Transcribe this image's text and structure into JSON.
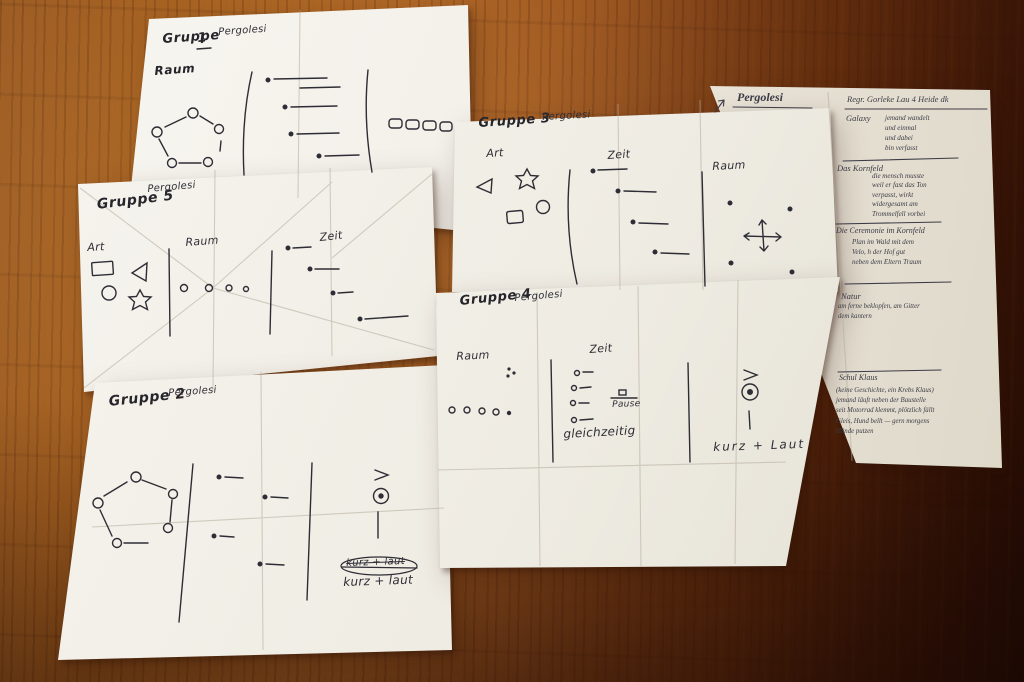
{
  "scene": {
    "description": "Five handwritten graphic-notation sketch sheets and one notes sheet on a wooden table",
    "colors": {
      "wood": "#9b5520",
      "wood_dark": "#431808",
      "paper": "#f2efe8",
      "ink": "#2e2d35"
    }
  },
  "papers": {
    "gruppe1": {
      "header": "Gruppe",
      "number": "1",
      "composer": "Pergolesi",
      "label_raum": "Raum"
    },
    "gruppe5": {
      "header": "Gruppe 5",
      "composer": "Pergolesi",
      "label_art": "Art",
      "label_raum": "Raum",
      "label_zeit": "Zeit"
    },
    "gruppe2": {
      "header": "Gruppe 2",
      "composer": "Pergolesi",
      "caption_struck": "kurz + laut",
      "caption": "kurz + laut"
    },
    "gruppe3": {
      "header": "Gruppe 3",
      "composer": "Pergolesi",
      "label_art": "Art",
      "label_zeit": "Zeit",
      "label_raum": "Raum"
    },
    "gruppe4": {
      "header": "Gruppe 4",
      "composer": "Pergolesi",
      "label_raum": "Raum",
      "label_zeit": "Zeit",
      "label_pause": "Pause",
      "label_gleichzeitig": "gleichzeitig",
      "caption": "kurz + Laut"
    },
    "notes": {
      "title": "Pergolesi",
      "header": "Regr. Gorleke Lau 4 Heide dk",
      "sections": [
        {
          "heading": "Galaxy",
          "body": "jemand wandelt\nund einmal\nund dabei\nbin verfasst"
        },
        {
          "heading": "Das Kornfeld",
          "body": "die mensch musste\nweil er fast das Ton\nverpasst, wirkt\nwidergesamt am\nTrommelfell vorbei"
        },
        {
          "heading": "Die Ceremonie im Kornfeld",
          "body": "Plan im Wald mit dem\nVelo, h der Hof gut\nneben dem Eltern Traum"
        },
        {
          "heading": "Natur",
          "body": "am ferne beklopfen, am Gitter\ndem kantern"
        },
        {
          "heading": "Schul Klaus",
          "body": "(keine Geschichte, ein Krebs Klaus)\njemand läuft neben der Baustelle\nseit Motorrad klemmt, plötzlich fällt\nGleis, Hund bellt — gern morgens\nHände putzen"
        }
      ]
    }
  }
}
